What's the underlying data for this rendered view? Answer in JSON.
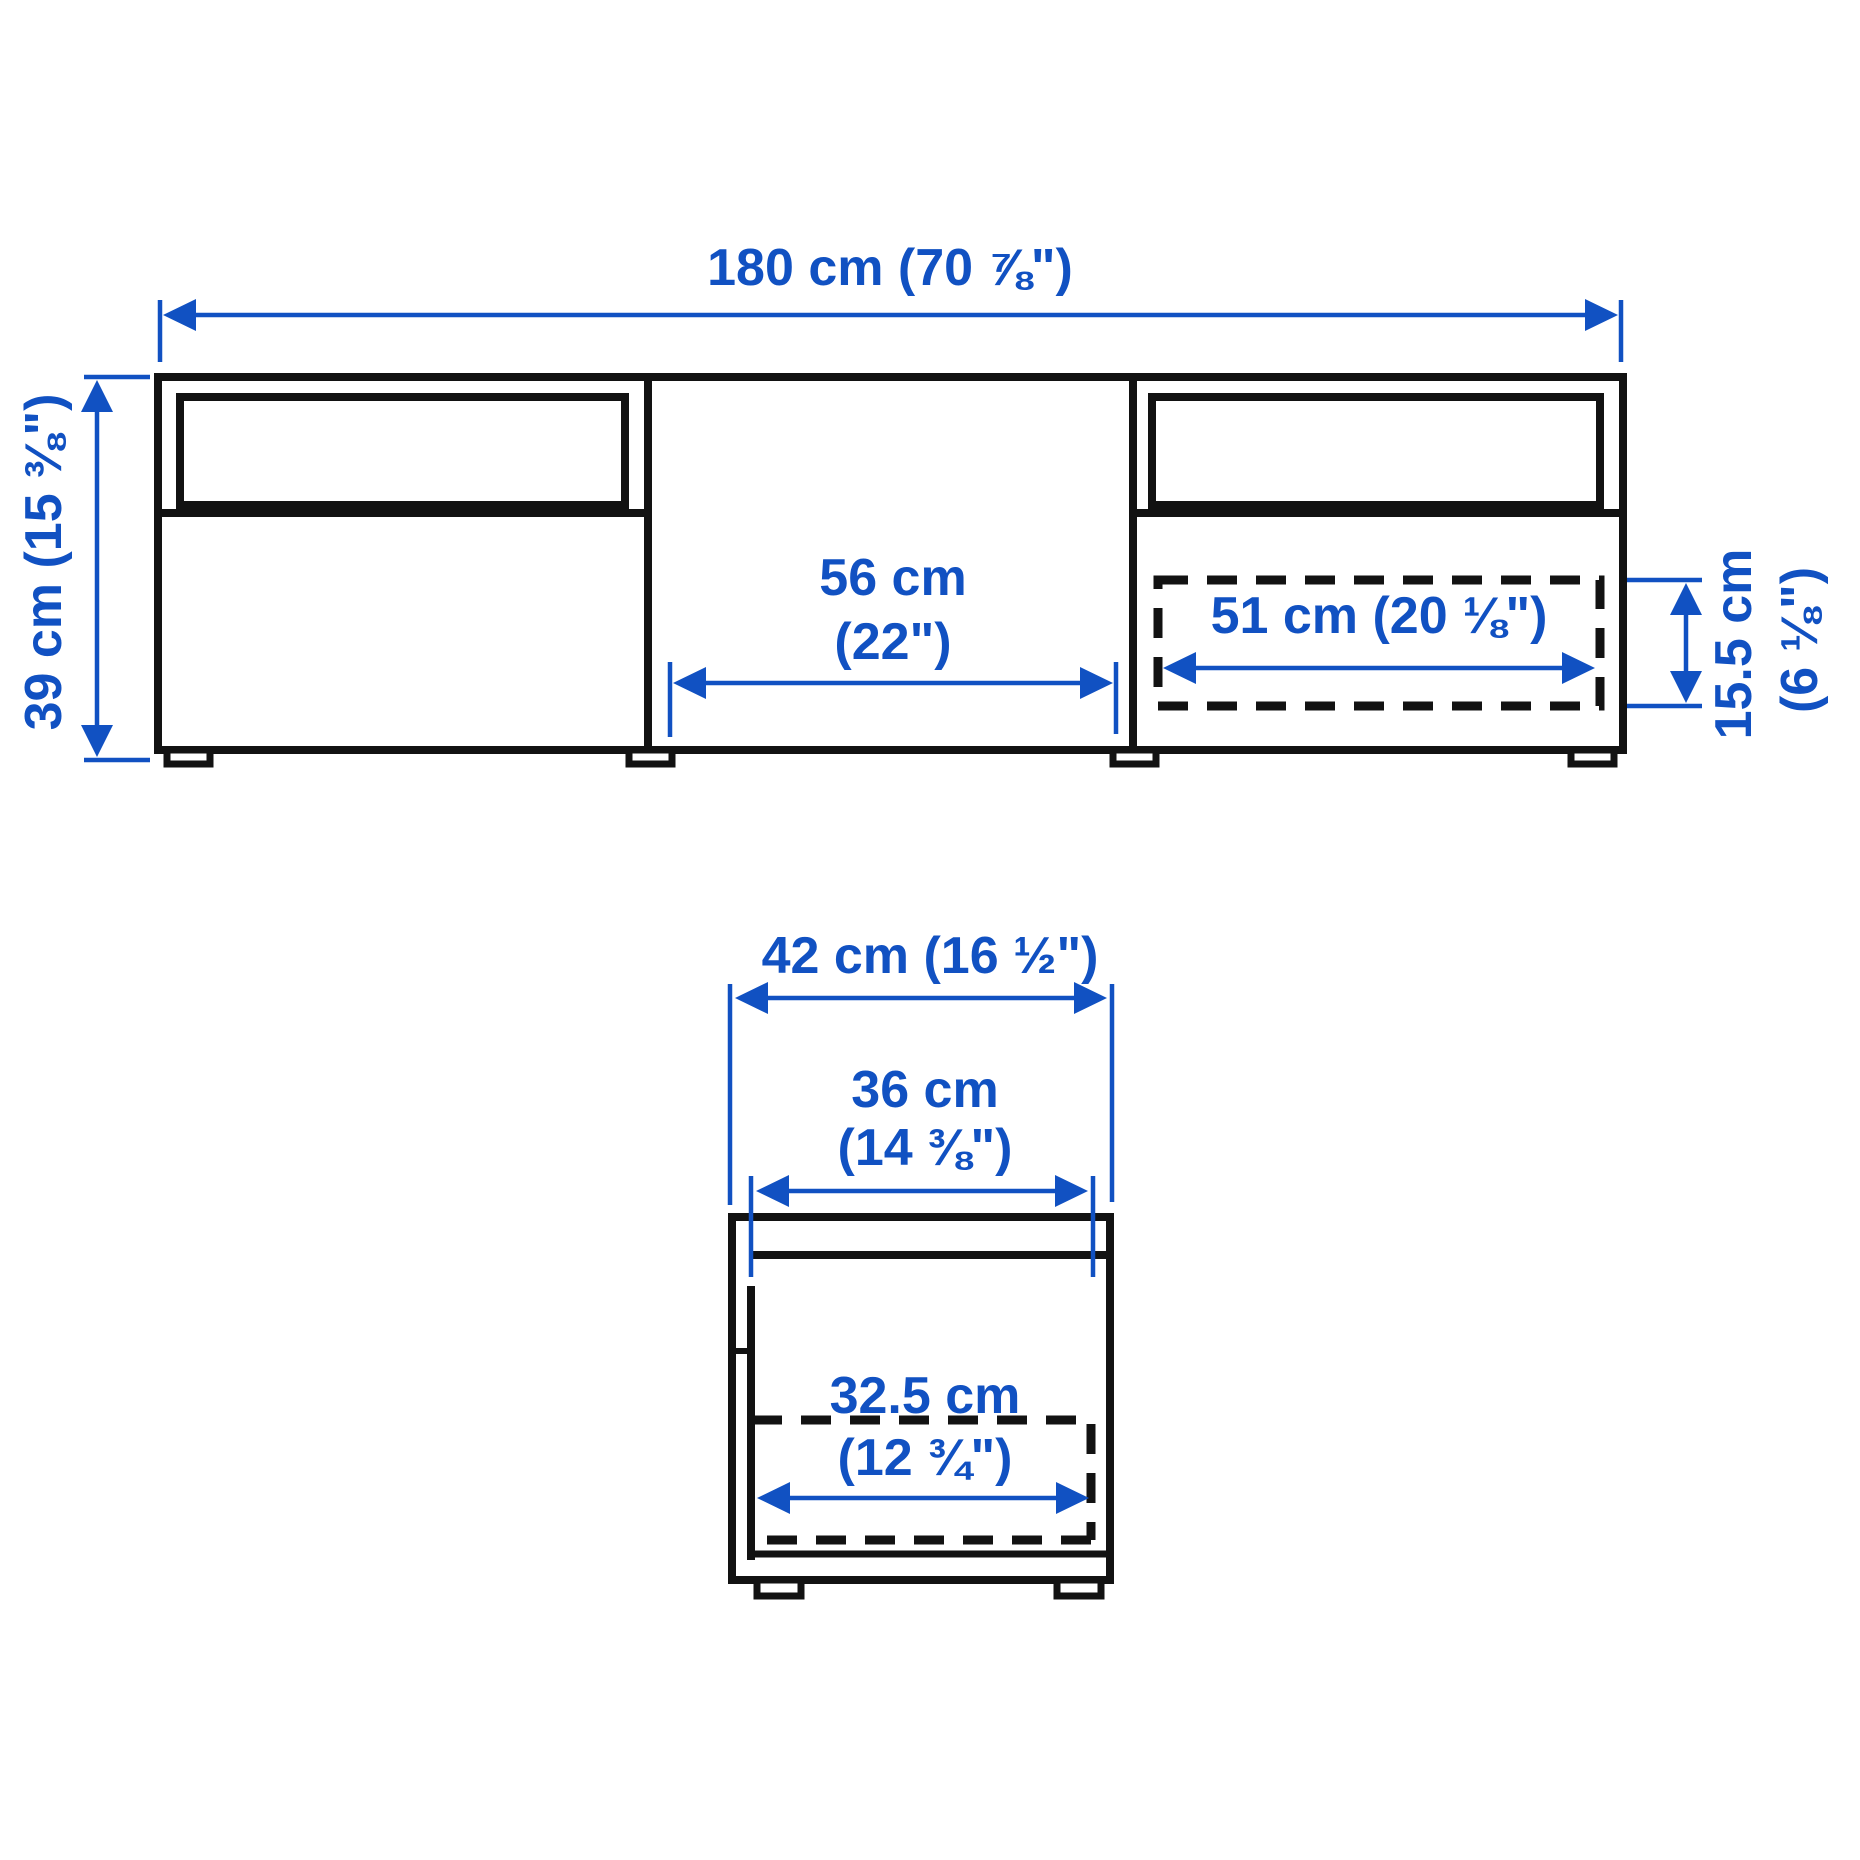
{
  "colors": {
    "dimension_blue": "#1151C2",
    "outline_black": "#121212",
    "background": "#FFFFFF"
  },
  "front_view": {
    "width_label": "180 cm (70 ⅞\")",
    "height_label": "39 cm (15 ⅜\")",
    "middle_opening_width": {
      "line1": "56 cm",
      "line2": "(22\")"
    },
    "drawer_inner_width": "51 cm (20 ⅛\")",
    "drawer_inner_height": {
      "line1": "15.5 cm",
      "line2": "(6 ⅛\")"
    }
  },
  "side_view": {
    "depth_label": "42 cm (16 ½\")",
    "inner_depth": {
      "line1": "36 cm",
      "line2": "(14 ⅜\")"
    },
    "drawer_inner_depth": {
      "line1": "32.5 cm",
      "line2": "(12 ¾\")"
    }
  }
}
